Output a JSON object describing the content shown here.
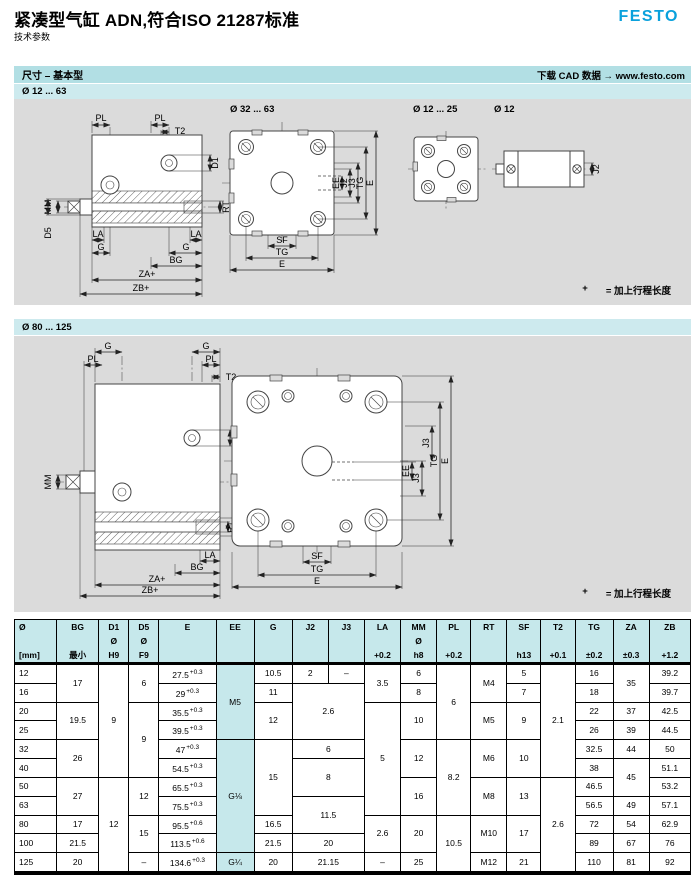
{
  "header": {
    "title": "紧凑型气缸 ADN,符合ISO 21287标准",
    "subtitle": "技术参数",
    "logo": "FESTO"
  },
  "section_bar": {
    "title": "尺寸 – 基本型",
    "cad_link": "下载 CAD 数据 → www.festo.com"
  },
  "colors": {
    "festo_blue": "#0aa1dc",
    "section_bar_cyan": "#b2dfe4",
    "range_row_cyan": "#cdeaee",
    "drawing_area_gray": "#dbdbdb",
    "table_header_cyan": "#c6e8eb"
  },
  "drawings": {
    "g1": {
      "range": "Ø 12 ... 63",
      "front_big": "Ø 32 ... 63",
      "front_small": "Ø 12 ... 25",
      "side_small": "Ø 12",
      "note_plus": "+",
      "note_eq": "= 加上行程长度",
      "side_dims": [
        "PL",
        "PL",
        "T2",
        "MM",
        "D5",
        "D1",
        "RT",
        "LA",
        "LA",
        "G",
        "G",
        "BG",
        "ZA+",
        "ZB+"
      ],
      "front_dims": [
        "EE",
        "J2",
        "J3",
        "TG",
        "E",
        "SF",
        "TG",
        "E"
      ],
      "small_dims": [
        "J2"
      ]
    },
    "g2": {
      "range": "Ø 80 ... 125",
      "note_plus": "+",
      "note_eq": "= 加上行程长度",
      "side_dims": [
        "G",
        "G",
        "PL",
        "PL",
        "T2",
        "MM",
        "D1",
        "RT",
        "D5",
        "LA",
        "BG",
        "ZA+",
        "ZB+"
      ],
      "front_dims": [
        "EE",
        "J3",
        "J3",
        "TG",
        "E",
        "SF",
        "TG",
        "E"
      ]
    }
  },
  "table": {
    "columns": [
      {
        "name": "Ø",
        "mid": "",
        "sub": "[mm]"
      },
      {
        "name": "BG",
        "mid": "",
        "sub": "最小"
      },
      {
        "name": "D1",
        "mid": "Ø",
        "sub": "H9"
      },
      {
        "name": "D5",
        "mid": "Ø",
        "sub": "F9"
      },
      {
        "name": "E",
        "mid": "",
        "sub": ""
      },
      {
        "name": "EE",
        "mid": "",
        "sub": ""
      },
      {
        "name": "G",
        "mid": "",
        "sub": ""
      },
      {
        "name": "J2",
        "mid": "",
        "sub": ""
      },
      {
        "name": "J3",
        "mid": "",
        "sub": ""
      },
      {
        "name": "LA",
        "mid": "",
        "sub": "+0.2"
      },
      {
        "name": "MM",
        "mid": "Ø",
        "sub": "h8"
      },
      {
        "name": "PL",
        "mid": "",
        "sub": "+0.2"
      },
      {
        "name": "RT",
        "mid": "",
        "sub": ""
      },
      {
        "name": "SF",
        "mid": "",
        "sub": "h13"
      },
      {
        "name": "T2",
        "mid": "",
        "sub": "+0.1"
      },
      {
        "name": "TG",
        "mid": "",
        "sub": "±0.2"
      },
      {
        "name": "ZA",
        "mid": "",
        "sub": "±0.3"
      },
      {
        "name": "ZB",
        "mid": "",
        "sub": "+1.2"
      }
    ],
    "rows": [
      [
        {
          "v": "12"
        },
        {
          "v": "17",
          "rs": 2
        },
        {
          "v": "9",
          "rs": 6
        },
        {
          "v": "6",
          "rs": 2
        },
        {
          "v": "27.5",
          "sup": "+0.3"
        },
        {
          "v": "M5",
          "rs": 4,
          "hl": 1
        },
        {
          "v": "10.5"
        },
        {
          "v": "2"
        },
        {
          "v": "–"
        },
        {
          "v": "3.5",
          "rs": 2
        },
        {
          "v": "6"
        },
        {
          "v": "6",
          "rs": 4
        },
        {
          "v": "M4",
          "rs": 2
        },
        {
          "v": "5"
        },
        {
          "v": "2.1",
          "rs": 6
        },
        {
          "v": "16"
        },
        {
          "v": "35",
          "rs": 2
        },
        {
          "v": "39.2"
        }
      ],
      [
        {
          "v": "16"
        },
        {
          "v": "29",
          "sup": "+0.3"
        },
        {
          "v": "11"
        },
        {
          "v": "2.6",
          "cs": 2,
          "rs": 3
        },
        {
          "v": "8"
        },
        {
          "v": "7"
        },
        {
          "v": "18"
        },
        {
          "v": "39.7"
        }
      ],
      [
        {
          "v": "20"
        },
        {
          "v": "19.5",
          "rs": 2
        },
        {
          "v": "9",
          "rs": 4
        },
        {
          "v": "35.5",
          "sup": "+0.3"
        },
        {
          "v": "12",
          "rs": 2
        },
        {
          "v": "5",
          "rs": 6
        },
        {
          "v": "10",
          "rs": 2
        },
        {
          "v": "M5",
          "rs": 2
        },
        {
          "v": "9",
          "rs": 2
        },
        {
          "v": "22"
        },
        {
          "v": "37"
        },
        {
          "v": "42.5"
        }
      ],
      [
        {
          "v": "25"
        },
        {
          "v": "39.5",
          "sup": "+0.3"
        },
        {
          "v": "26"
        },
        {
          "v": "39"
        },
        {
          "v": "44.5"
        }
      ],
      [
        {
          "v": "32"
        },
        {
          "v": "26",
          "rs": 2
        },
        {
          "v": "47",
          "sup": "+0.3"
        },
        {
          "v": "G⅛",
          "rs": 6,
          "hl": 1
        },
        {
          "v": "15",
          "rs": 4
        },
        {
          "v": "6",
          "cs": 2
        },
        {
          "v": "12",
          "rs": 2
        },
        {
          "v": "8.2",
          "rs": 4
        },
        {
          "v": "M6",
          "rs": 2
        },
        {
          "v": "10",
          "rs": 2
        },
        {
          "v": "32.5"
        },
        {
          "v": "44"
        },
        {
          "v": "50"
        }
      ],
      [
        {
          "v": "40"
        },
        {
          "v": "54.5",
          "sup": "+0.3"
        },
        {
          "v": "8",
          "cs": 2,
          "rs": 2
        },
        {
          "v": "38"
        },
        {
          "v": "45",
          "rs": 2
        },
        {
          "v": "51.1"
        }
      ],
      [
        {
          "v": "50"
        },
        {
          "v": "27",
          "rs": 2
        },
        {
          "v": "12",
          "rs": 5
        },
        {
          "v": "12",
          "rs": 2
        },
        {
          "v": "65.5",
          "sup": "+0.3"
        },
        {
          "v": "16",
          "rs": 2
        },
        {
          "v": "M8",
          "rs": 2
        },
        {
          "v": "13",
          "rs": 2
        },
        {
          "v": "2.6",
          "rs": 5
        },
        {
          "v": "46.5"
        },
        {
          "v": "53.2"
        }
      ],
      [
        {
          "v": "63"
        },
        {
          "v": "75.5",
          "sup": "+0.3"
        },
        {
          "v": "11.5",
          "cs": 2,
          "rs": 2
        },
        {
          "v": "56.5"
        },
        {
          "v": "49"
        },
        {
          "v": "57.1"
        }
      ],
      [
        {
          "v": "80"
        },
        {
          "v": "17"
        },
        {
          "v": "15",
          "rs": 2
        },
        {
          "v": "95.5",
          "sup": "+0.6"
        },
        {
          "v": "16.5"
        },
        {
          "v": "2.6",
          "rs": 2
        },
        {
          "v": "20",
          "rs": 2
        },
        {
          "v": "10.5",
          "rs": 3
        },
        {
          "v": "M10",
          "rs": 2
        },
        {
          "v": "17",
          "rs": 2
        },
        {
          "v": "72"
        },
        {
          "v": "54"
        },
        {
          "v": "62.9"
        }
      ],
      [
        {
          "v": "100"
        },
        {
          "v": "21.5"
        },
        {
          "v": "113.5",
          "sup": "+0.6"
        },
        {
          "v": "21.5"
        },
        {
          "v": "20",
          "cs": 2
        },
        {
          "v": "89"
        },
        {
          "v": "67"
        },
        {
          "v": "76"
        }
      ],
      [
        {
          "v": "125"
        },
        {
          "v": "20"
        },
        {
          "v": "–"
        },
        {
          "v": "134.6",
          "sup": "+0.3"
        },
        {
          "v": "G¼",
          "hl": 1
        },
        {
          "v": "20"
        },
        {
          "v": "21.15",
          "cs": 2
        },
        {
          "v": "–"
        },
        {
          "v": "25"
        },
        {
          "v": "M12"
        },
        {
          "v": "21"
        },
        {
          "v": "110"
        },
        {
          "v": "81"
        },
        {
          "v": "92"
        }
      ]
    ]
  }
}
